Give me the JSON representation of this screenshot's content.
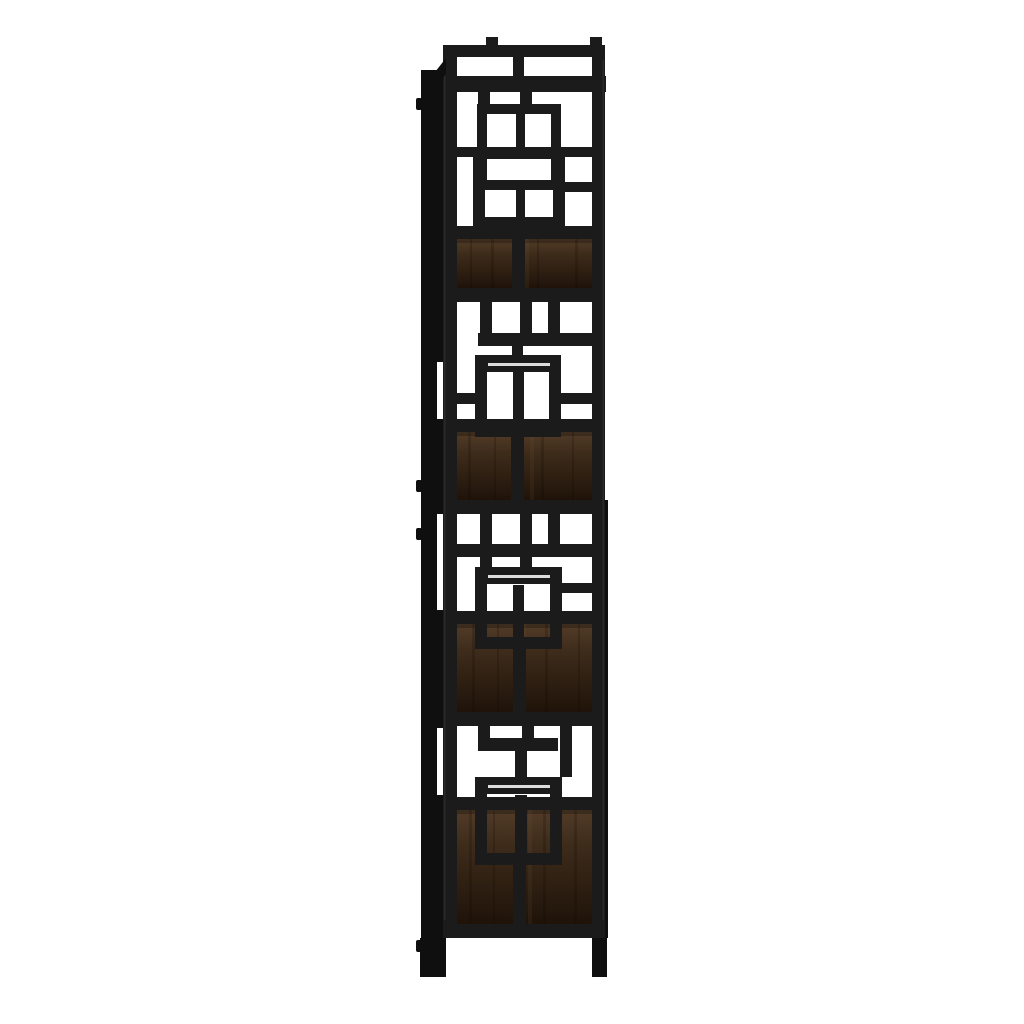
{
  "scene": {
    "description": "Side profile product photo of a tall etagere bookcase: black metal frame with a geometric overlapping-squares lattice side panel and four dark espresso wood shelves, isolated on a white background",
    "object": "bookcase",
    "view": "side profile",
    "shelf_count": "4",
    "material_frame": "black metal",
    "material_shelves": "espresso wood"
  },
  "colors": {
    "background": "#ffffff",
    "frame_black": "#1b1b1b",
    "frame_dark": "#0f0f0f",
    "frame_highlight": "#3e3e3e",
    "shelf_wood_light": "#523c28",
    "shelf_wood_mid": "#3e2c1b",
    "shelf_wood_dark": "#1f1309",
    "grain_dark": "#0f0803",
    "grain_light": "#7a5c3d"
  }
}
